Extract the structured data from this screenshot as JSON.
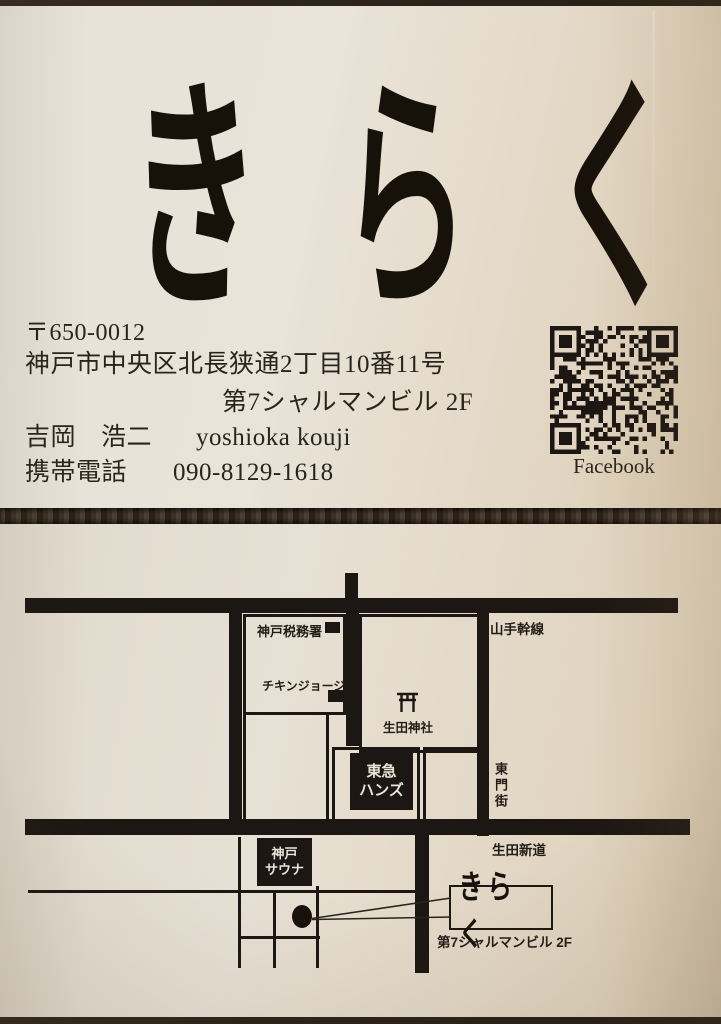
{
  "card_front": {
    "logo_chars": [
      "き",
      "ら",
      "く"
    ],
    "postal_code": "〒650-0012",
    "address_line1": "神戸市中央区北長狭通2丁目10番11号",
    "address_line2": "第7シャルマンビル 2F",
    "name_kanji_family": "吉岡",
    "name_kanji_given": "浩二",
    "name_romaji": "yoshioka kouji",
    "phone_label": "携帯電話",
    "phone_number": "090-8129-1618",
    "qr_caption": "Facebook"
  },
  "map_card": {
    "roads": {
      "yamate_kansen": "山手幹線",
      "higashimon_gai": "東門街",
      "ikuta_shindo": "生田新道"
    },
    "landmarks": {
      "tax_office": "神戸税務署",
      "chicken_george": "チキンジョージ",
      "ikuta_shrine": "生田神社",
      "tokyu_hands": [
        "東急",
        "ハンズ"
      ],
      "kobe_sauna": [
        "神戸",
        "サウナ"
      ],
      "shop_name": "きらく",
      "shop_building": "第7シャルマンビル 2F"
    }
  },
  "colors": {
    "photo_background": "#2b2218",
    "card_paper": "#e7e0d4",
    "ink": "#1c1712"
  }
}
